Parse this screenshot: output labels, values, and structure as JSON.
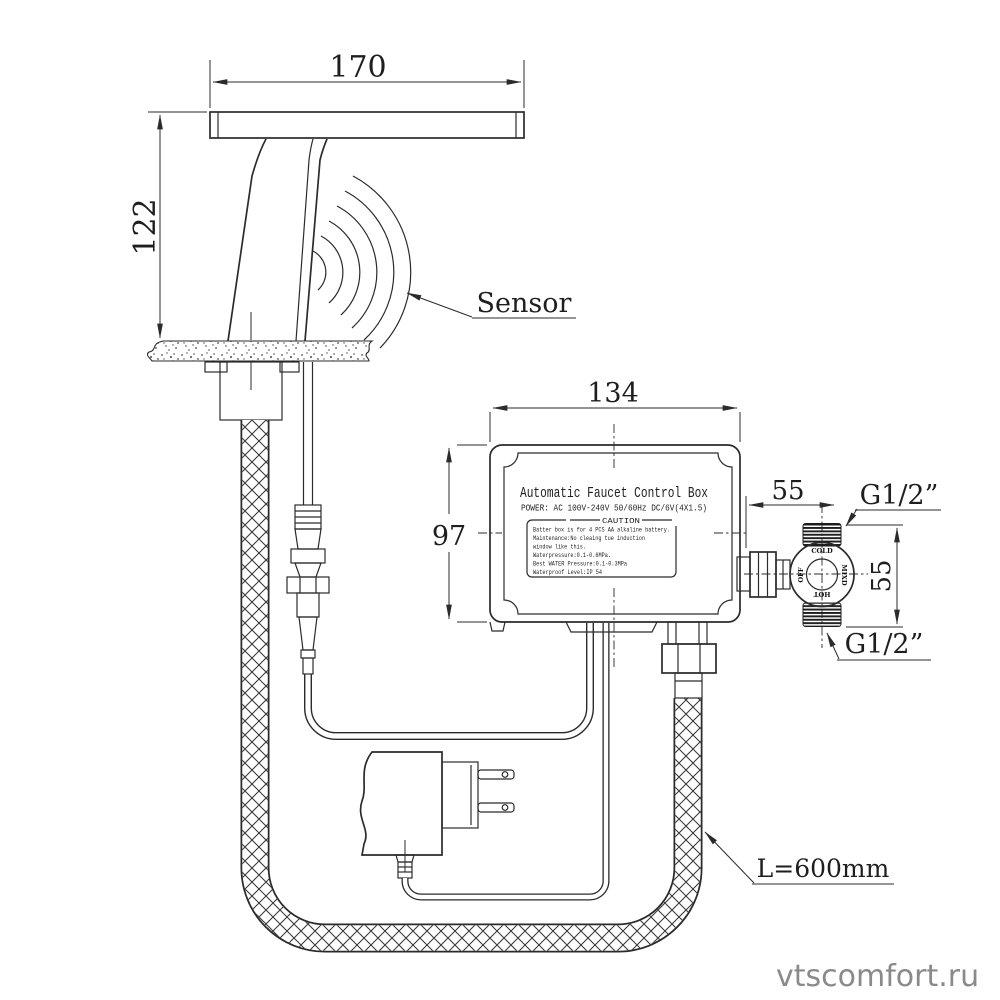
{
  "drawing": {
    "title_note": "automatic sensor faucet installation diagram",
    "watermark": "vtscomfort.ru",
    "labels": {
      "sensor": "Sensor",
      "hose_length": "L=600mm",
      "thread_top": "G1/2”",
      "thread_bottom": "G1/2”"
    },
    "dimensions": {
      "spout_width": "170",
      "faucet_height": "122",
      "box_width": "134",
      "box_height": "97",
      "valve_width": "55",
      "valve_height": "55"
    },
    "control_box": {
      "title": "Automatic Faucet Control Box",
      "power": "POWER: AC 100V-240V 50/60Hz DC/6V(4X1.5)",
      "caution_title": "CAUTION",
      "caution_lines": [
        "Batter box is for 4 PCS AA alkaline battery.",
        "Maintenance:No cleaing tue induction",
        "window like this.",
        "Waterpressure:0.1-0.6MPa.",
        "Best WATER Pressure:0.1-0.3MPa",
        "Waterproof Level:IP 54"
      ]
    },
    "valve": {
      "port_top": "COLD",
      "port_left": "OFF",
      "port_bottom": "HOT",
      "port_right": "MIXD"
    },
    "colors": {
      "line": "#2b2b2b",
      "watermark": "#8a8a8a",
      "background": "#ffffff"
    }
  }
}
